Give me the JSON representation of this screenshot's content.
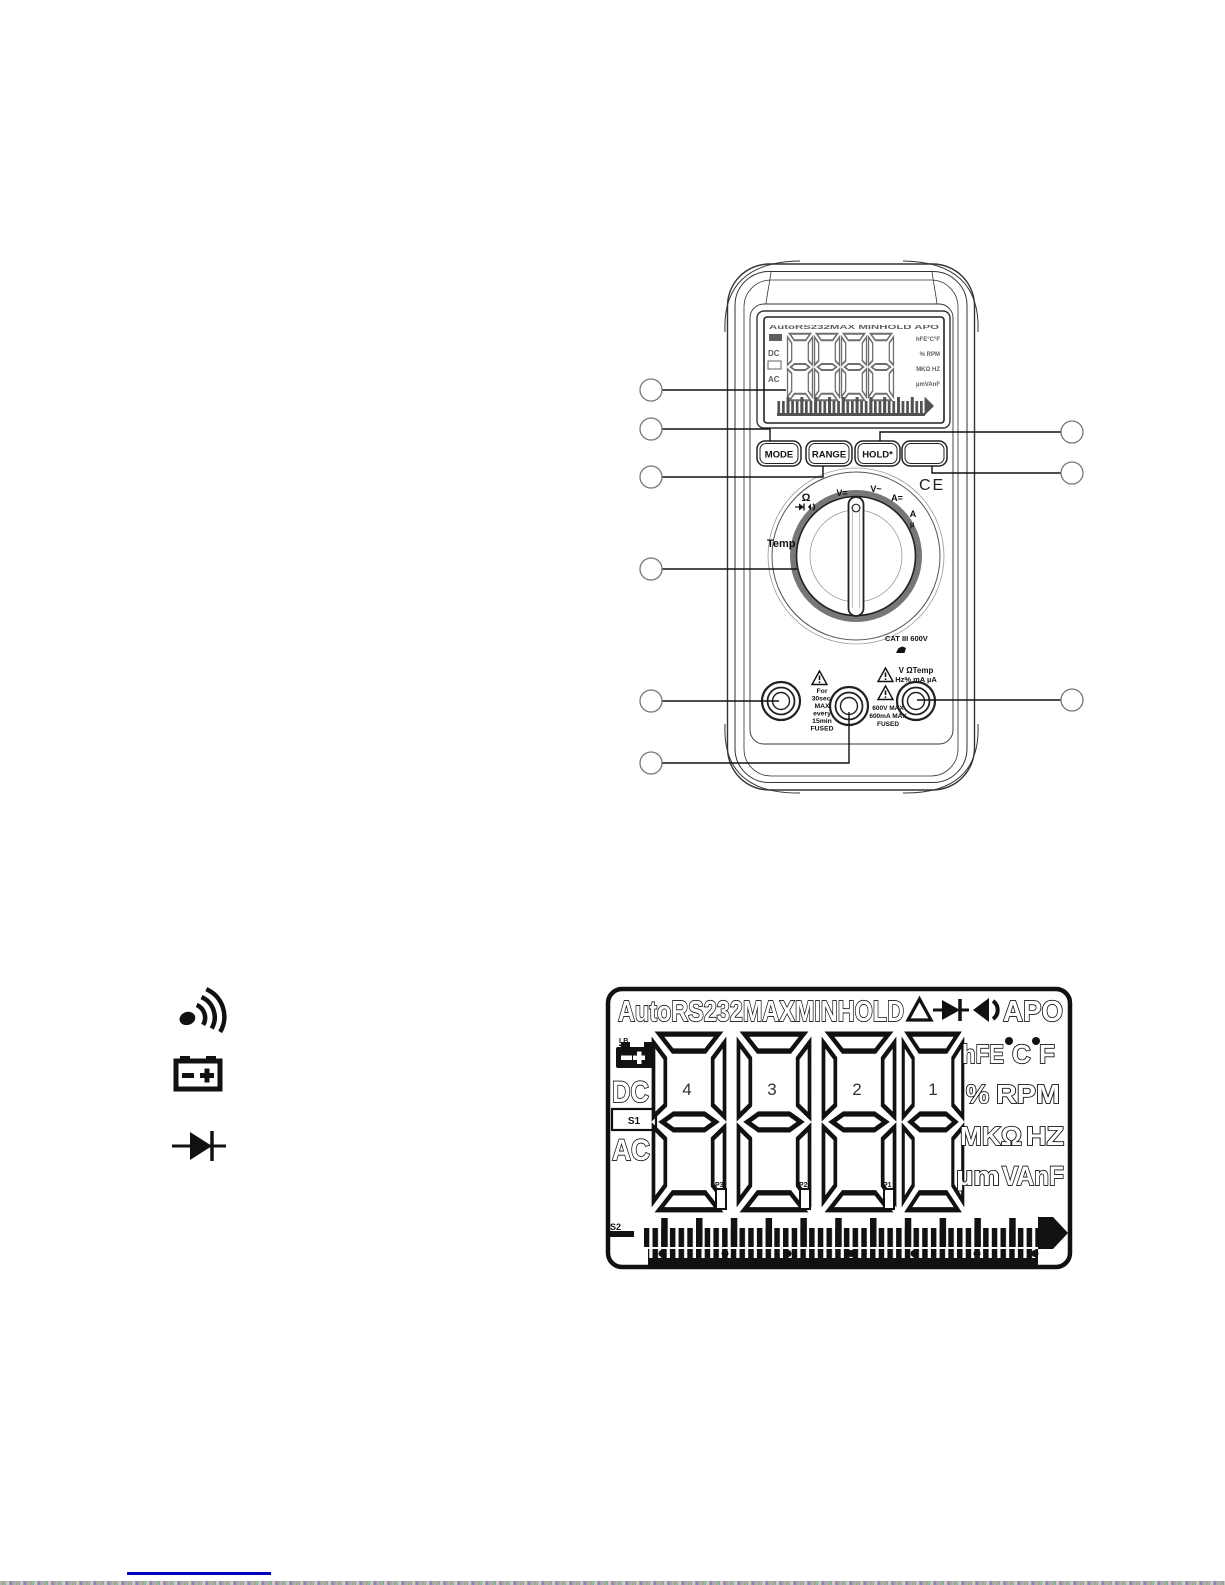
{
  "page": {
    "background": "#ffffff",
    "ink": "#111111",
    "accent_line_color": "#0000bb"
  },
  "meter": {
    "buttons": {
      "mode": "MODE",
      "range": "RANGE",
      "hold": "HOLD*",
      "blank": ""
    },
    "display": {
      "annunciators": "AutoRS232MAX MINHOLD APO",
      "dc": "DC",
      "ac": "AC",
      "right_rows": [
        "hFE°C°F",
        "% RPM",
        "MKΩ HZ",
        "µmVAnF"
      ]
    },
    "dial": {
      "temp": "Temp",
      "ohm": "Ω",
      "pos_v_dc": "V=",
      "pos_v_ac": "V~",
      "pos_a_dc": "A=",
      "pos_a_ac": "A",
      "pos_micro": "µ"
    },
    "ce_mark": "CE",
    "cat_rating": "CAT III 600V",
    "jack_left_warning": [
      "For",
      "30sec.",
      "MAX",
      "every",
      "15min",
      "FUSED"
    ],
    "jack_mid_warning": [
      "600V MAX",
      "600mA MAX",
      "FUSED"
    ],
    "jack_right_label": [
      "V ΩTemp",
      "Hz% mA µA"
    ]
  },
  "lcd": {
    "annunciators": "AutoRS232MAXMINHOLD",
    "apo": "APO",
    "lb": "LB",
    "dc": "DC",
    "s1": "S1",
    "ac": "AC",
    "digit_labels": [
      "4",
      "3",
      "2",
      "1"
    ],
    "decimal_labels": [
      "P3",
      "P2",
      "P1"
    ],
    "s2": "S2",
    "right_row1": [
      "hFE",
      "C",
      "F"
    ],
    "right_row2": [
      "%",
      "RPM"
    ],
    "right_row3": [
      "MKΩ",
      "HZ"
    ],
    "right_row4": [
      "µm",
      "VAnF"
    ]
  }
}
